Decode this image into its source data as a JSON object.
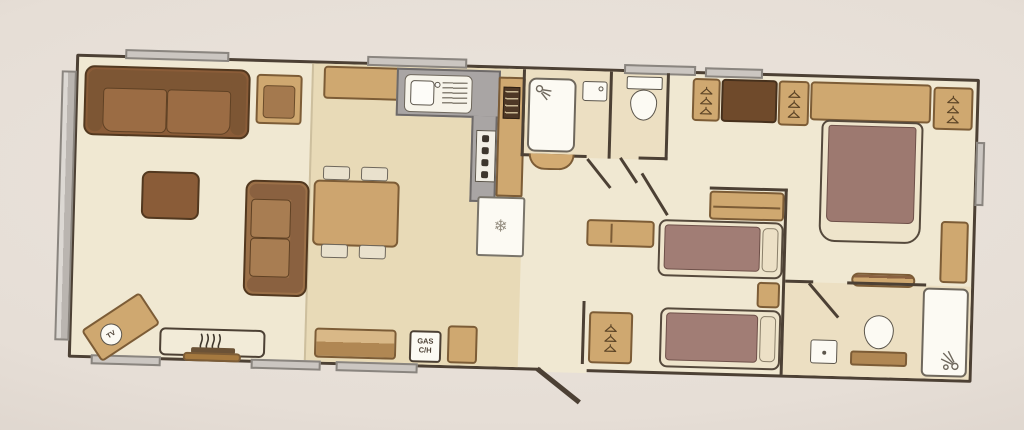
{
  "labels": {
    "tv": "TV",
    "gas_line1": "GAS",
    "gas_line2": "C/H"
  },
  "icons": {
    "fridge_snowflake": "❄",
    "wardrobe_icon": "coat-hanger",
    "shower_icon": "shower-head",
    "fire_icon": "flame-squiggles"
  },
  "palette": {
    "photo_background": "#e6ded6",
    "floor_cream": "#f0e8d2",
    "floor_kitchen_tan": "#e8dab7",
    "floor_bathroom": "#ecdfc2",
    "wall": "#4c4034",
    "furniture_tan": "#cfa870",
    "furniture_brown": "#8a5c38",
    "chest_dark_brown": "#6f4a2b",
    "mattress_mauve": "#a17d75",
    "bed_frame_cream": "#eee4cb",
    "worktop_gray": "#a9a5a4",
    "fixture_white": "#fcfaf3",
    "window_tab_gray": "#cbc6c1"
  },
  "plan": {
    "type": "static-caravan-floorplan",
    "rooms": [
      {
        "name": "lounge",
        "furniture": [
          "two-seat sofa",
          "corner sofa",
          "armchair",
          "coffee table",
          "TV corner unit",
          "electric fire"
        ]
      },
      {
        "name": "dining area",
        "furniture": [
          "dining table",
          "4 chairs",
          "sideboard",
          "storage bench"
        ]
      },
      {
        "name": "kitchen",
        "furniture": [
          "L-shaped worktop",
          "sink and drainer",
          "oven microwave tower",
          "hob",
          "fridge freezer",
          "gas central heating locker"
        ]
      },
      {
        "name": "shower room",
        "furniture": [
          "shower cubicle",
          "wash basin"
        ]
      },
      {
        "name": "wc",
        "furniture": [
          "toilet"
        ]
      },
      {
        "name": "twin bedroom",
        "furniture": [
          "single bed",
          "single bed",
          "wardrobe",
          "wardrobe",
          "chest of drawers",
          "bedside unit",
          "vanity unit"
        ]
      },
      {
        "name": "main bedroom",
        "furniture": [
          "double bed",
          "overhead cupboards",
          "wardrobe",
          "wardrobe",
          "bedside cabinet",
          "dressing table"
        ]
      },
      {
        "name": "en-suite",
        "furniture": [
          "shower cubicle",
          "toilet",
          "wash basin"
        ]
      }
    ]
  }
}
